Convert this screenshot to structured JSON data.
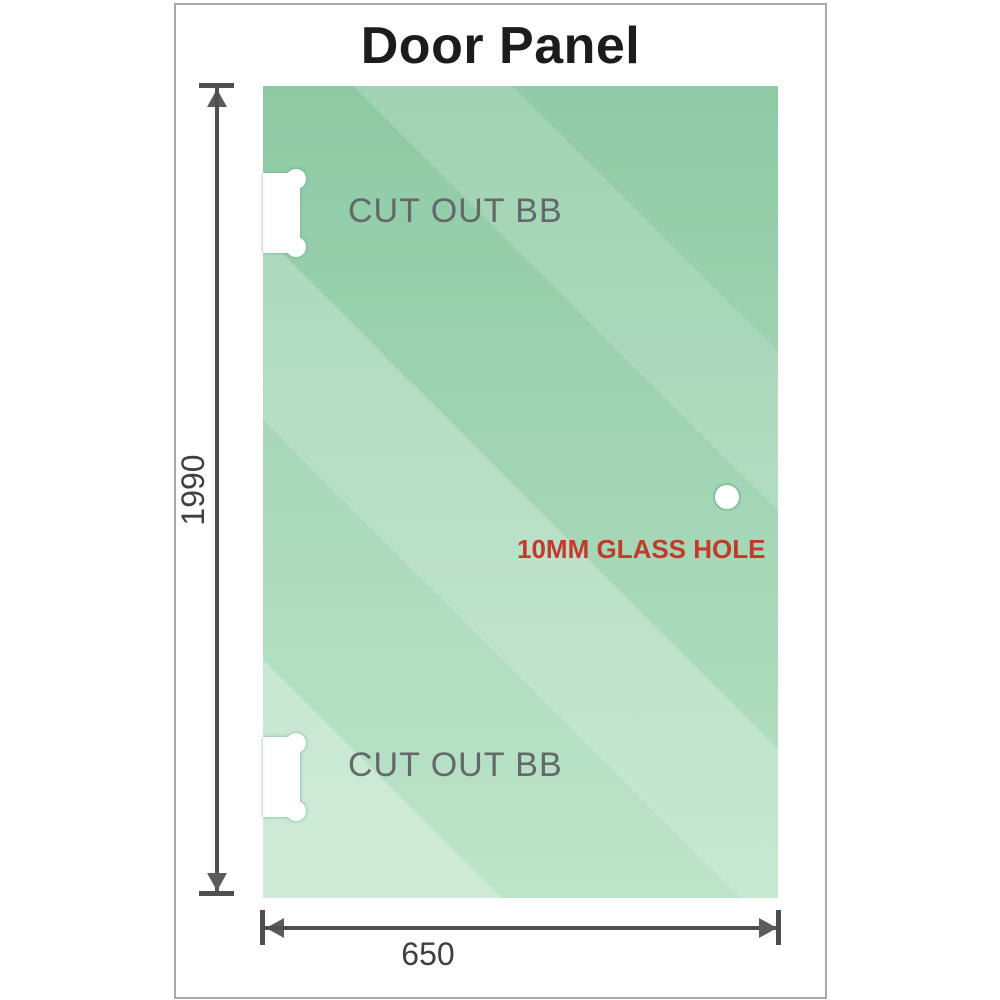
{
  "title": "Door Panel",
  "diagram": {
    "cutout_label_top": "CUT OUT BB",
    "cutout_label_bottom": "CUT OUT BB",
    "hole_label": "10MM GLASS HOLE",
    "height_dimension": "1990",
    "width_dimension": "650"
  },
  "colors": {
    "glass_top": "#8bc8a2",
    "glass_bottom": "#b5e1c3",
    "frame_border": "#a8a8a8",
    "dimension_line": "#4f4f4f",
    "cutout_label_gray": "#63686a",
    "hole_label_red": "#c23a2c"
  }
}
